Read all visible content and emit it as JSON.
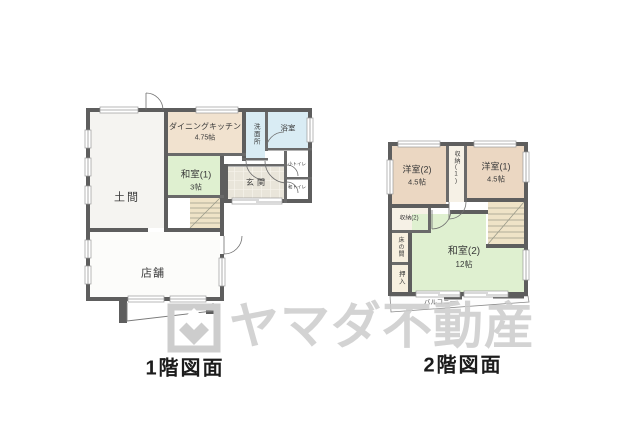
{
  "watermark": {
    "text": "ヤマダ不動産",
    "logo": "yamada-square-diamond-logo",
    "color": "#cdcdcd"
  },
  "colors": {
    "wall": "#5e5e5e",
    "doma": "#f5f4f1",
    "shop": "#fcfcfa",
    "dining_kitchen": "#f1e2cf",
    "japanese_room": "#dff0d0",
    "water_room": "#d9ecf4",
    "entrance": "#e9e5da",
    "western_room": "#ebd7c2",
    "closet": "#f6f1e6",
    "alcove": "#f7efdf",
    "stairs": "#efe3c7",
    "balcony": "#fdfdfd"
  },
  "floor1": {
    "caption": "1階図面",
    "rooms": {
      "doma": "土間",
      "dining_kitchen": "ダイニングキッチン",
      "dining_kitchen_size": "4.75帖",
      "washitsu1": "和室(1)",
      "washitsu1_size": "3帖",
      "senmenjo": "洗面所",
      "yokushitsu": "浴室",
      "genkan": "玄関",
      "toilet_small": "小トイレ",
      "toilet_japanese": "和トイレ",
      "shop": "店舗"
    }
  },
  "floor2": {
    "caption": "2階図面",
    "rooms": {
      "yoshitsu2": "洋室(2)",
      "yoshitsu2_size": "4.5帖",
      "yoshitsu1": "洋室(1)",
      "yoshitsu1_size": "4.5帖",
      "shuno1": "収納(1)",
      "shuno2": "収納(2)",
      "tokonoma": "床の間",
      "oshiire": "押入",
      "washitsu2": "和室(2)",
      "washitsu2_size": "12帖",
      "balcony": "バルコニー"
    }
  }
}
